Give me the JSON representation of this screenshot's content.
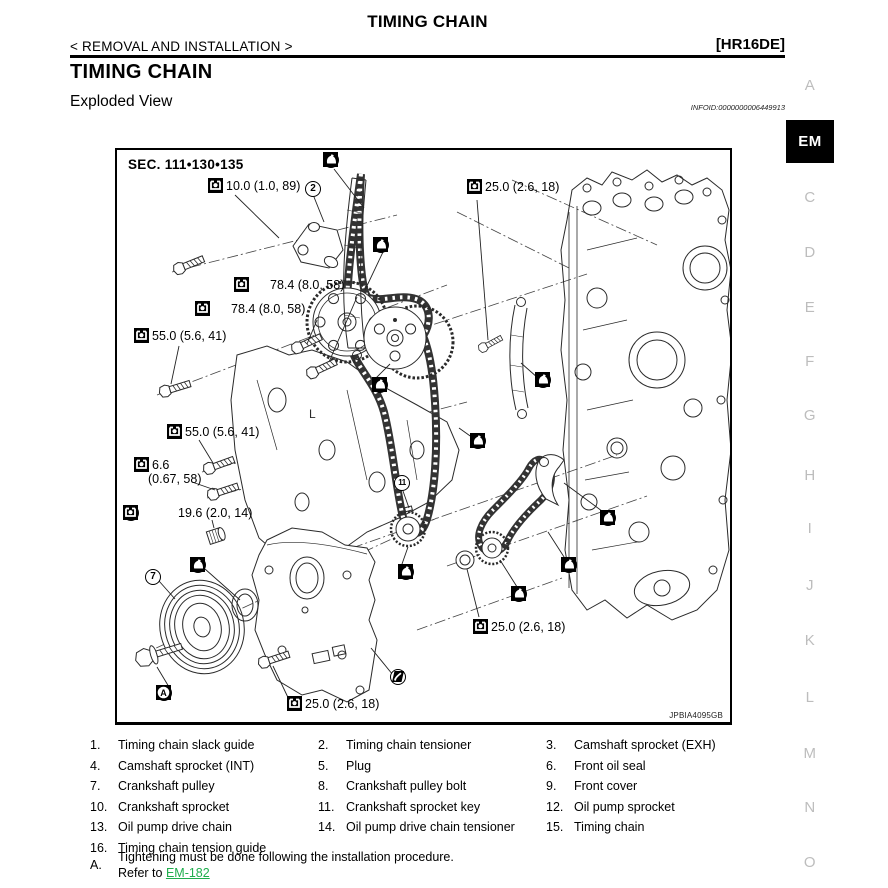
{
  "page": {
    "header_title": "TIMING CHAIN",
    "breadcrumb": "< REMOVAL AND INSTALLATION >",
    "engine_code": "[HR16DE]",
    "section_title": "TIMING CHAIN",
    "subsection_title": "Exploded View",
    "infoid": "INFOID:0000000006449913"
  },
  "colors": {
    "link_green": "#1fae4d",
    "sidebar_gray": "#bdbdbd"
  },
  "sidebar": {
    "letters": [
      {
        "label": "A",
        "active": false,
        "y": 77
      },
      {
        "label": "EM",
        "active": true,
        "y": 120
      },
      {
        "label": "C",
        "active": false,
        "y": 189
      },
      {
        "label": "D",
        "active": false,
        "y": 244
      },
      {
        "label": "E",
        "active": false,
        "y": 299
      },
      {
        "label": "F",
        "active": false,
        "y": 353
      },
      {
        "label": "G",
        "active": false,
        "y": 407
      },
      {
        "label": "H",
        "active": false,
        "y": 467
      },
      {
        "label": "I",
        "active": false,
        "y": 520
      },
      {
        "label": "J",
        "active": false,
        "y": 577
      },
      {
        "label": "K",
        "active": false,
        "y": 632
      },
      {
        "label": "L",
        "active": false,
        "y": 689
      },
      {
        "label": "M",
        "active": false,
        "y": 745
      },
      {
        "label": "N",
        "active": false,
        "y": 799
      },
      {
        "label": "O",
        "active": false,
        "y": 854
      }
    ]
  },
  "diagram": {
    "sec_label": "SEC. 111•130•135",
    "figure_code": "JPBIA4095GB",
    "callouts": [
      {
        "balloon": "1",
        "icons": [
          "oil"
        ],
        "text": "",
        "x": 206,
        "y": 2
      },
      {
        "balloon": null,
        "icons": [
          "torque"
        ],
        "text": "10.0 (1.0, 89)",
        "x": 91,
        "y": 28
      },
      {
        "balloon": "2",
        "icons": [],
        "text": "",
        "x": 188,
        "y": 31
      },
      {
        "balloon": null,
        "icons": [
          "torque"
        ],
        "text": "25.0 (2.6, 18)",
        "x": 350,
        "y": 29
      },
      {
        "balloon": "3",
        "icons": [
          "oil"
        ],
        "text": "",
        "x": 256,
        "y": 87
      },
      {
        "balloon": null,
        "icons": [
          "oil",
          "torque"
        ],
        "text": "78.4 (8.0, 58)",
        "x": 117,
        "y": 127
      },
      {
        "balloon": null,
        "icons": [
          "oil",
          "torque"
        ],
        "text": "78.4 (8.0, 58)",
        "x": 78,
        "y": 151
      },
      {
        "balloon": null,
        "icons": [
          "torque"
        ],
        "text": "55.0 (5.6, 41)",
        "x": 17,
        "y": 178
      },
      {
        "balloon": "4",
        "icons": [
          "oil"
        ],
        "text": "",
        "x": 255,
        "y": 227
      },
      {
        "balloon": null,
        "icons": [
          "torque"
        ],
        "text": "55.0 (5.6, 41)",
        "x": 50,
        "y": 274
      },
      {
        "balloon": null,
        "icons": [
          "torque"
        ],
        "text": "6.6",
        "text2": "(0.67, 58)",
        "x": 17,
        "y": 307
      },
      {
        "balloon": "5",
        "icons": [
          "sealant",
          "torque"
        ],
        "text": "19.6 (2.0, 14)",
        "x": 6,
        "y": 355
      },
      {
        "balloon": "11",
        "icons": [],
        "text": "",
        "x": 277,
        "y": 325
      },
      {
        "balloon": "15",
        "icons": [
          "oil"
        ],
        "text": "",
        "x": 353,
        "y": 283
      },
      {
        "balloon": "16",
        "icons": [
          "oil"
        ],
        "text": "",
        "x": 418,
        "y": 222
      },
      {
        "balloon": "6",
        "icons": [
          "donotreuse",
          "oil"
        ],
        "text": "",
        "x": 73,
        "y": 407
      },
      {
        "balloon": "7",
        "icons": [],
        "text": "",
        "x": 28,
        "y": 419
      },
      {
        "balloon": "10",
        "icons": [
          "oil"
        ],
        "text": "",
        "x": 281,
        "y": 414
      },
      {
        "balloon": "12",
        "icons": [
          "oil"
        ],
        "text": "",
        "x": 394,
        "y": 436
      },
      {
        "balloon": "13",
        "icons": [
          "oil"
        ],
        "text": "",
        "x": 444,
        "y": 407
      },
      {
        "balloon": "14",
        "icons": [
          "oil"
        ],
        "text": "",
        "x": 483,
        "y": 360
      },
      {
        "balloon": "8",
        "icons": [
          "oil",
          "torque",
          "refA"
        ],
        "text": "",
        "x": 39,
        "y": 535
      },
      {
        "balloon": "9",
        "icons": [
          "sealant"
        ],
        "text": "",
        "x": 273,
        "y": 519
      },
      {
        "balloon": null,
        "icons": [
          "torque"
        ],
        "text": "25.0 (2.6, 18)",
        "x": 170,
        "y": 546
      },
      {
        "balloon": null,
        "icons": [
          "torque"
        ],
        "text": "25.0 (2.6, 18)",
        "x": 356,
        "y": 469
      }
    ]
  },
  "legend": {
    "items": [
      {
        "num": "1.",
        "label": "Timing chain slack guide"
      },
      {
        "num": "2.",
        "label": "Timing chain tensioner"
      },
      {
        "num": "3.",
        "label": "Camshaft sprocket (EXH)"
      },
      {
        "num": "4.",
        "label": "Camshaft sprocket (INT)"
      },
      {
        "num": "5.",
        "label": "Plug"
      },
      {
        "num": "6.",
        "label": "Front oil seal"
      },
      {
        "num": "7.",
        "label": "Crankshaft pulley"
      },
      {
        "num": "8.",
        "label": "Crankshaft pulley bolt"
      },
      {
        "num": "9.",
        "label": "Front cover"
      },
      {
        "num": "10.",
        "label": "Crankshaft sprocket"
      },
      {
        "num": "11.",
        "label": "Crankshaft sprocket key"
      },
      {
        "num": "12.",
        "label": "Oil pump sprocket"
      },
      {
        "num": "13.",
        "label": "Oil pump drive chain"
      },
      {
        "num": "14.",
        "label": "Oil pump drive chain tensioner"
      },
      {
        "num": "15.",
        "label": "Timing chain"
      },
      {
        "num": "16.",
        "label": "Timing chain tension guide"
      }
    ],
    "note_num": "A.",
    "note_line1": "Tightening must be done following the installation procedure.",
    "note_line2_prefix": "Refer to ",
    "note_link": "EM-182"
  }
}
